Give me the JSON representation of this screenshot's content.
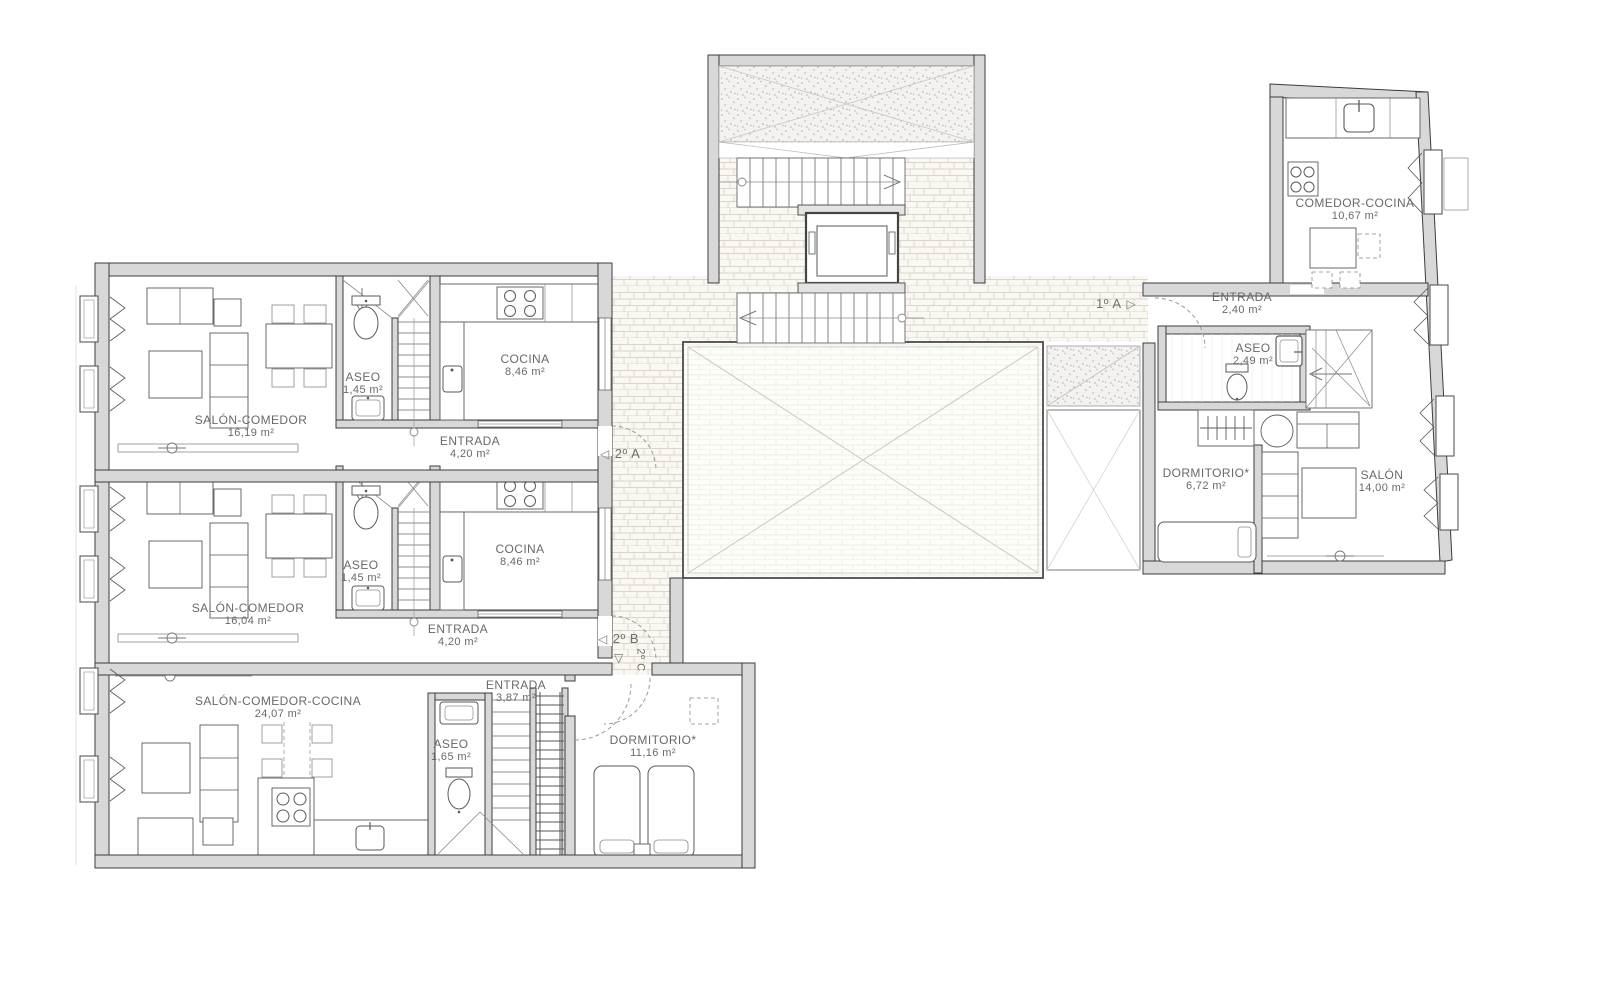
{
  "palette": {
    "wall_fill": "#d8d8d8",
    "wall_outline": "#3c3c3c",
    "stone_floor_tone": "#faf8f3",
    "patio_tone": "#fdfdfa",
    "label_text": "#696969"
  },
  "icons": {
    "door_left": "◁",
    "door_right": "▷",
    "door_down": "▽"
  },
  "apartments": {
    "a2A": {
      "marker": "2º A",
      "rooms": {
        "salon": {
          "name": "SALÓN-COMEDOR",
          "area": "16,19 m²"
        },
        "aseo": {
          "name": "ASEO",
          "area": "1,45 m²"
        },
        "cocina": {
          "name": "COCINA",
          "area": "8,46 m²"
        },
        "entrada": {
          "name": "ENTRADA",
          "area": "4,20 m²"
        }
      }
    },
    "a2B": {
      "marker": "2º B",
      "rooms": {
        "salon": {
          "name": "SALÓN-COMEDOR",
          "area": "16,04 m²"
        },
        "aseo": {
          "name": "ASEO",
          "area": "1,45 m²"
        },
        "cocina": {
          "name": "COCINA",
          "area": "8,46 m²"
        },
        "entrada": {
          "name": "ENTRADA",
          "area": "4,20 m²"
        }
      }
    },
    "a2C": {
      "marker": "2º C",
      "rooms": {
        "salon": {
          "name": "SALÓN-COMEDOR-COCINA",
          "area": "24,07 m²"
        },
        "entrada": {
          "name": "ENTRADA",
          "area": "3,87 m²"
        },
        "aseo": {
          "name": "ASEO",
          "area": "1,65 m²"
        },
        "dormitorio": {
          "name": "DORMITORIO*",
          "area": "11,16 m²"
        }
      }
    },
    "a1A": {
      "marker": "1º A",
      "rooms": {
        "entrada": {
          "name": "ENTRADA",
          "area": "2,40 m²"
        },
        "aseo": {
          "name": "ASEO",
          "area": "2,49 m²"
        },
        "dormitorio": {
          "name": "DORMITORIO*",
          "area": "6,72 m²"
        },
        "salon": {
          "name": "SALÓN",
          "area": "14,00 m²"
        },
        "comedor_cocina": {
          "name": "COMEDOR-COCINA",
          "area": "10,67 m²"
        }
      }
    }
  }
}
